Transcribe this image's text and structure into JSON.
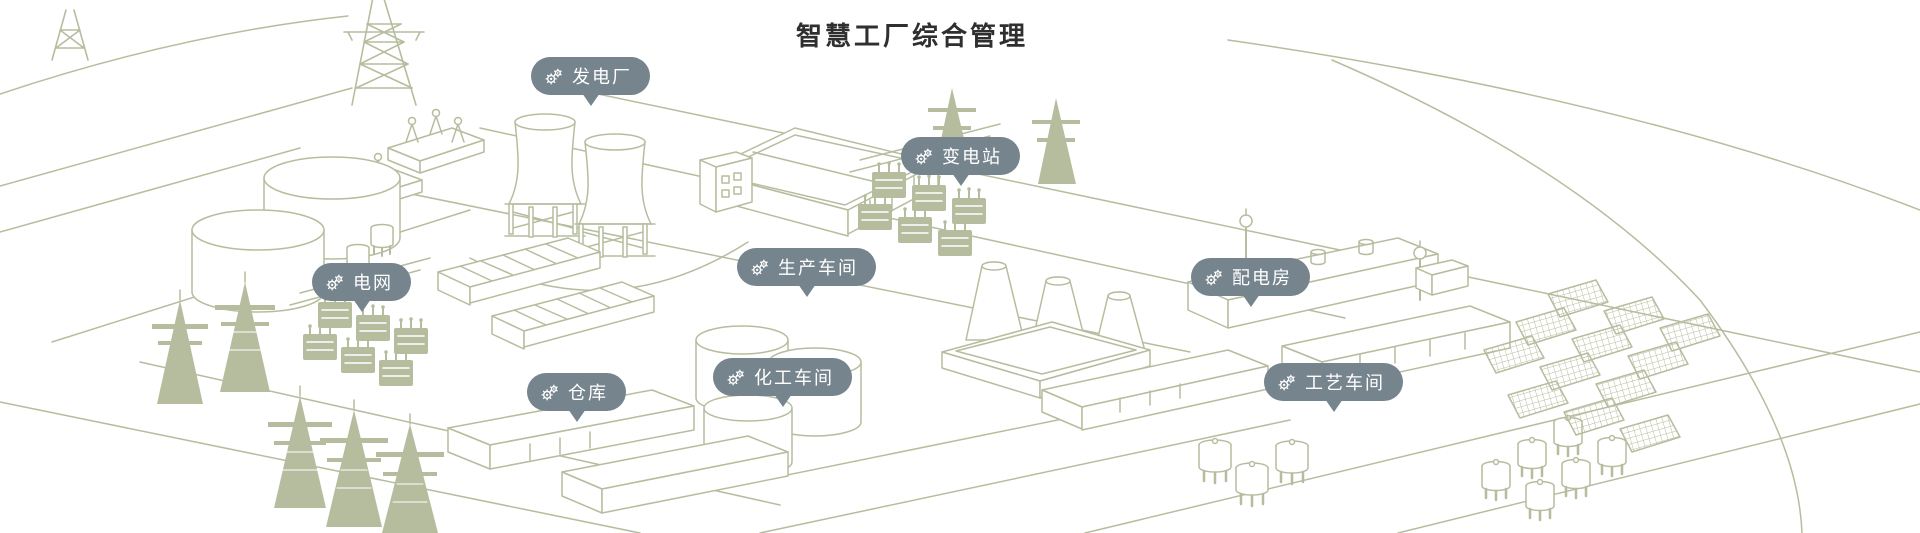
{
  "title": "智慧工厂综合管理",
  "colors": {
    "background": "#ffffff",
    "line_art": "#b6bd9e",
    "pin_background": "#76848e",
    "pin_text": "#ffffff",
    "title_text": "#2f2f2f"
  },
  "icons": {
    "pin_icon": "gears-icon"
  },
  "pins": [
    {
      "id": "power-plant",
      "label": "发电厂"
    },
    {
      "id": "substation",
      "label": "变电站"
    },
    {
      "id": "power-grid",
      "label": "电网"
    },
    {
      "id": "production-workshop",
      "label": "生产车间"
    },
    {
      "id": "distribution-room",
      "label": "配电房"
    },
    {
      "id": "warehouse",
      "label": "仓库"
    },
    {
      "id": "chemical-workshop",
      "label": "化工车间"
    },
    {
      "id": "process-workshop",
      "label": "工艺车间"
    }
  ]
}
